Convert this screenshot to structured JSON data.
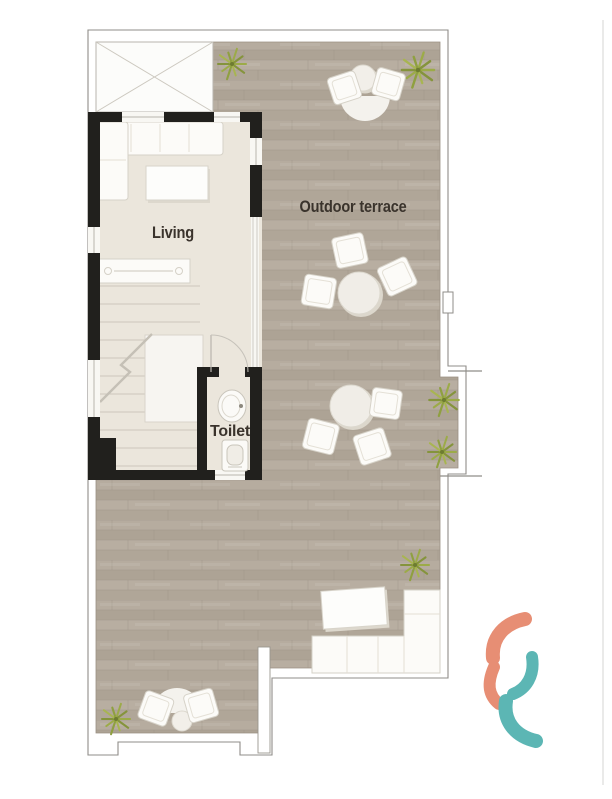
{
  "plan": {
    "labels": {
      "living": "Living",
      "toilet": "Toilet",
      "terrace": "Outdoor terrace"
    },
    "colors": {
      "wood": "#b3a99c",
      "wood_line": "#9a9083",
      "living_floor": "#ebe6dc",
      "skylight": "#fcfcfa",
      "wall": "#21201d",
      "outline": "#8f8d89",
      "furniture": "#fcfbf8",
      "furniture_outline": "#d6d2c8",
      "rug": "#f4f2ed",
      "label": "#3a332c",
      "plant": "#9aa845"
    },
    "furniture": {
      "living_room": [
        "corner-sofa",
        "coffee-table",
        "tv-console",
        "staircase"
      ],
      "toilet_room": [
        "washbasin",
        "wc"
      ],
      "terrace": [
        "dining-set",
        "dining-set",
        "dining-set",
        "lounge-set",
        "corner-bench",
        "outdoor-table"
      ],
      "plant_count": 6
    }
  },
  "logo": {
    "salmon": "#e78e74",
    "teal": "#5cb6b4"
  }
}
